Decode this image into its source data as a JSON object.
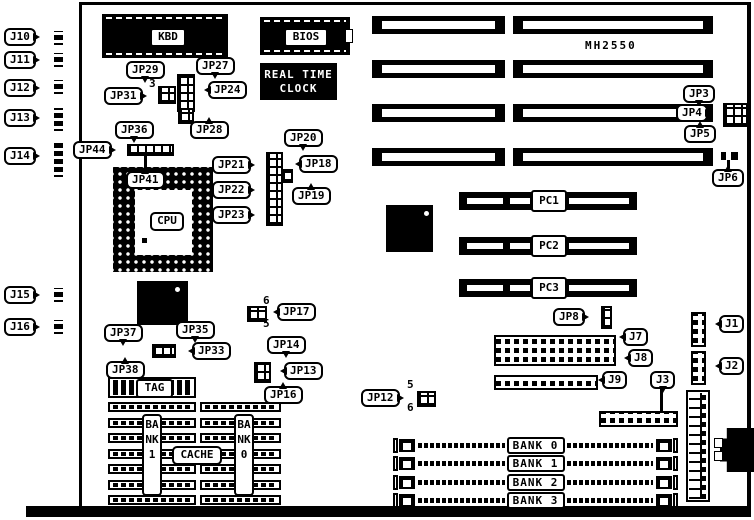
{
  "board": {
    "name": "MH2550"
  },
  "chips": {
    "kbd": "KBD",
    "bios": "BIOS",
    "rtc_line1": "REAL TIME",
    "rtc_line2": "CLOCK",
    "cpu": "CPU",
    "tag": "TAG",
    "cache": "CACHE",
    "bank_left_vertical": "BANK1",
    "bank_right_vertical": "BANK0"
  },
  "pci_slots": [
    "PC1",
    "PC2",
    "PC3"
  ],
  "simm_banks": [
    "BANK 0",
    "BANK 1",
    "BANK 2",
    "BANK 3"
  ],
  "colors": {
    "ink": "#000000",
    "paper": "#ffffff"
  },
  "callouts": [
    {
      "id": "j10",
      "text": "J10",
      "x": 4,
      "y": 28,
      "tail": "r"
    },
    {
      "id": "j11",
      "text": "J11",
      "x": 4,
      "y": 51,
      "tail": "r"
    },
    {
      "id": "j12",
      "text": "J12",
      "x": 4,
      "y": 79,
      "tail": "r"
    },
    {
      "id": "j13",
      "text": "J13",
      "x": 4,
      "y": 109,
      "tail": "r"
    },
    {
      "id": "j14",
      "text": "J14",
      "x": 4,
      "y": 147,
      "tail": "r"
    },
    {
      "id": "j15",
      "text": "J15",
      "x": 4,
      "y": 286,
      "tail": "r"
    },
    {
      "id": "j16",
      "text": "J16",
      "x": 4,
      "y": 318,
      "tail": "r"
    },
    {
      "id": "jp29",
      "text": "JP29",
      "x": 126,
      "y": 61,
      "tail": "d"
    },
    {
      "id": "jp27",
      "text": "JP27",
      "x": 196,
      "y": 57,
      "tail": "d"
    },
    {
      "id": "jp31",
      "text": "JP31",
      "x": 104,
      "y": 87,
      "tail": "r"
    },
    {
      "id": "jp24",
      "text": "JP24",
      "x": 208,
      "y": 81,
      "tail": "l"
    },
    {
      "id": "jp28",
      "text": "JP28",
      "x": 190,
      "y": 121,
      "tail": "u"
    },
    {
      "id": "jp36",
      "text": "JP36",
      "x": 115,
      "y": 121,
      "tail": "d"
    },
    {
      "id": "jp44",
      "text": "JP44",
      "x": 73,
      "y": 141,
      "tail": "r"
    },
    {
      "id": "jp41",
      "text": "JP41",
      "x": 126,
      "y": 171,
      "tail": "u"
    },
    {
      "id": "jp20",
      "text": "JP20",
      "x": 284,
      "y": 129,
      "tail": "d"
    },
    {
      "id": "jp21",
      "text": "JP21",
      "x": 212,
      "y": 156,
      "tail": "r"
    },
    {
      "id": "jp18",
      "text": "JP18",
      "x": 299,
      "y": 155,
      "tail": "l"
    },
    {
      "id": "jp22",
      "text": "JP22",
      "x": 212,
      "y": 181,
      "tail": "r"
    },
    {
      "id": "jp19",
      "text": "JP19",
      "x": 292,
      "y": 187,
      "tail": "u"
    },
    {
      "id": "jp23",
      "text": "JP23",
      "x": 212,
      "y": 206,
      "tail": "r"
    },
    {
      "id": "jp3",
      "text": "JP3",
      "x": 683,
      "y": 85,
      "tail": "d"
    },
    {
      "id": "jp4",
      "text": "JP4",
      "x": 676,
      "y": 104,
      "tail": "r"
    },
    {
      "id": "jp5",
      "text": "JP5",
      "x": 684,
      "y": 125,
      "tail": "u"
    },
    {
      "id": "jp6",
      "text": "JP6",
      "x": 712,
      "y": 169,
      "tail": "u"
    },
    {
      "id": "jp37",
      "text": "JP37",
      "x": 104,
      "y": 324,
      "tail": "d"
    },
    {
      "id": "jp35",
      "text": "JP35",
      "x": 176,
      "y": 321,
      "tail": "d"
    },
    {
      "id": "jp33",
      "text": "JP33",
      "x": 192,
      "y": 342,
      "tail": "l"
    },
    {
      "id": "jp38",
      "text": "JP38",
      "x": 106,
      "y": 361,
      "tail": "u"
    },
    {
      "id": "jp17",
      "text": "JP17",
      "x": 277,
      "y": 303,
      "tail": "l"
    },
    {
      "id": "jp14",
      "text": "JP14",
      "x": 267,
      "y": 336,
      "tail": "d"
    },
    {
      "id": "jp13",
      "text": "JP13",
      "x": 284,
      "y": 362,
      "tail": "l"
    },
    {
      "id": "jp16",
      "text": "JP16",
      "x": 264,
      "y": 386,
      "tail": "u"
    },
    {
      "id": "jp12",
      "text": "JP12",
      "x": 361,
      "y": 389,
      "tail": "r"
    },
    {
      "id": "jp8",
      "text": "JP8",
      "x": 553,
      "y": 308,
      "tail": "r"
    },
    {
      "id": "j7",
      "text": "J7",
      "x": 623,
      "y": 328,
      "tail": "l"
    },
    {
      "id": "j8",
      "text": "J8",
      "x": 628,
      "y": 349,
      "tail": "l"
    },
    {
      "id": "j9",
      "text": "J9",
      "x": 602,
      "y": 371,
      "tail": "l"
    },
    {
      "id": "j3",
      "text": "J3",
      "x": 650,
      "y": 371,
      "tail": "d"
    },
    {
      "id": "j1",
      "text": "J1",
      "x": 719,
      "y": 315,
      "tail": "l"
    },
    {
      "id": "j2",
      "text": "J2",
      "x": 719,
      "y": 357,
      "tail": "l"
    }
  ],
  "pin_numbers": [
    {
      "id": "jp31-pin3",
      "text": "3",
      "x": 149,
      "y": 77
    },
    {
      "id": "jp17-pin6",
      "text": "6",
      "x": 263,
      "y": 294
    },
    {
      "id": "jp17-pin5",
      "text": "5",
      "x": 263,
      "y": 317
    },
    {
      "id": "jp12-pin5",
      "text": "5",
      "x": 407,
      "y": 378
    },
    {
      "id": "jp12-pin6",
      "text": "6",
      "x": 407,
      "y": 401
    }
  ]
}
